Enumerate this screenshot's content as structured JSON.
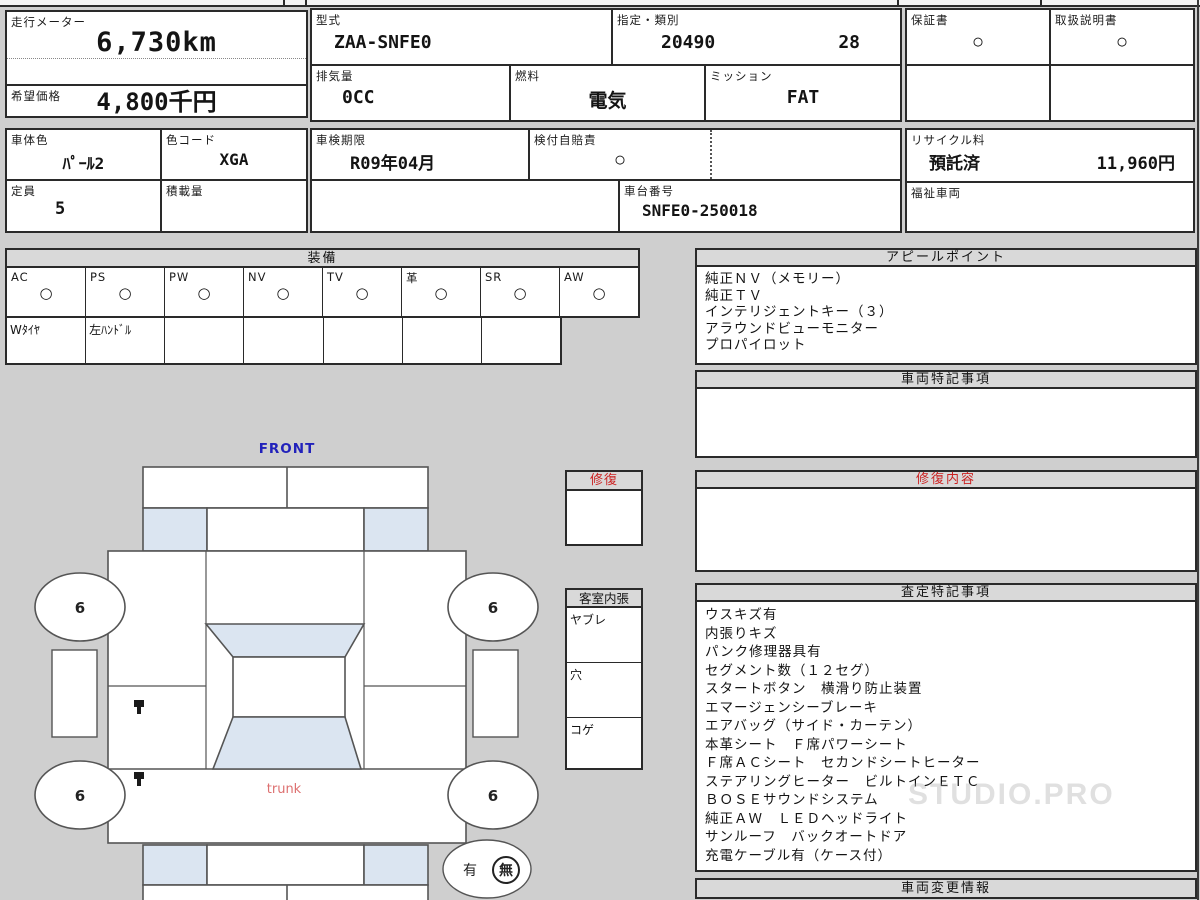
{
  "meta": {
    "odometer_label": "走行メーター",
    "odometer_value": "6,730km",
    "price_label": "希望価格",
    "price_value": "4,800千円"
  },
  "vehicle": {
    "model_label": "型式",
    "model": "ZAA-SNFE0",
    "class_label": "指定・類別",
    "class_no": "20490",
    "class_sub": "28",
    "disp_label": "排気量",
    "disp": "0CC",
    "fuel_label": "燃料",
    "fuel": "電気",
    "trans_label": "ミッション",
    "trans": "FAT",
    "inspect_label": "車検期限",
    "inspect": "R09年04月",
    "insurance_label": "検付自賠責",
    "insurance_mark": "○",
    "chassis_label": "車台番号",
    "chassis": "SNFE0-250018",
    "warranty_label": "保証書",
    "warranty_mark": "○",
    "manual_label": "取扱説明書",
    "manual_mark": "○",
    "recycle_label": "リサイクル料",
    "recycle_status": "預託済",
    "recycle_fee": "11,960円",
    "welfare_label": "福祉車両",
    "body_color_label": "車体色",
    "body_color": "ﾊﾟｰﾙ2",
    "color_code_label": "色コード",
    "color_code": "XGA",
    "capacity_label": "定員",
    "capacity": "5",
    "load_label": "積載量"
  },
  "equipment": {
    "title": "装備",
    "columns": [
      {
        "label": "AC",
        "mark": "○"
      },
      {
        "label": "PS",
        "mark": "○"
      },
      {
        "label": "PW",
        "mark": "○"
      },
      {
        "label": "NV",
        "mark": "○"
      },
      {
        "label": "TV",
        "mark": "○"
      },
      {
        "label": "革",
        "mark": "○"
      },
      {
        "label": "SR",
        "mark": "○"
      },
      {
        "label": "AW",
        "mark": "○"
      }
    ],
    "notes": [
      "Wﾀｲﾔ",
      "左ﾊﾝﾄﾞﾙ"
    ]
  },
  "appeal": {
    "title": "アピールポイント",
    "items": [
      "純正ＮＶ（メモリー）",
      "純正ＴＶ",
      "インテリジェントキー（３）",
      "アラウンドビューモニター",
      "プロパイロット"
    ]
  },
  "special": {
    "title": "車両特記事項"
  },
  "repair_detail": {
    "title": "修復内容"
  },
  "assessment": {
    "title": "査定特記事項",
    "items": [
      "ウスキズ有",
      "内張りキズ",
      "パンク修理器具有",
      "セグメント数（１２セグ）",
      "スタートボタン　横滑り防止装置",
      "エマージェンシーブレーキ",
      "エアバッグ（サイド・カーテン）",
      "本革シート　Ｆ席パワーシート",
      "Ｆ席ＡＣシート　セカンドシートヒーター",
      "ステアリングヒーター　ビルトインＥＴＣ",
      "ＢＯＳＥサウンドシステム",
      "純正ＡＷ　ＬＥＤヘッドライト",
      "サンルーフ　バックオートドア",
      "充電ケーブル有（ケース付）"
    ]
  },
  "change_info": {
    "title": "車両変更情報"
  },
  "repair_box": {
    "title": "修復"
  },
  "interior": {
    "title": "客室内張",
    "rows": [
      "ヤブレ",
      "穴",
      "コゲ"
    ]
  },
  "diagram": {
    "front_label": "FRONT",
    "trunk_label": "trunk",
    "wheel_mark": "6",
    "presence": {
      "yes": "有",
      "no": "無"
    }
  },
  "watermark": {
    "text": "STUDIO.PRO"
  },
  "colors": {
    "accent_blue": "#2222bb",
    "accent_red": "#cc2222",
    "trunk_red": "#dd7070",
    "fill_blue": "#dbe5f1"
  }
}
